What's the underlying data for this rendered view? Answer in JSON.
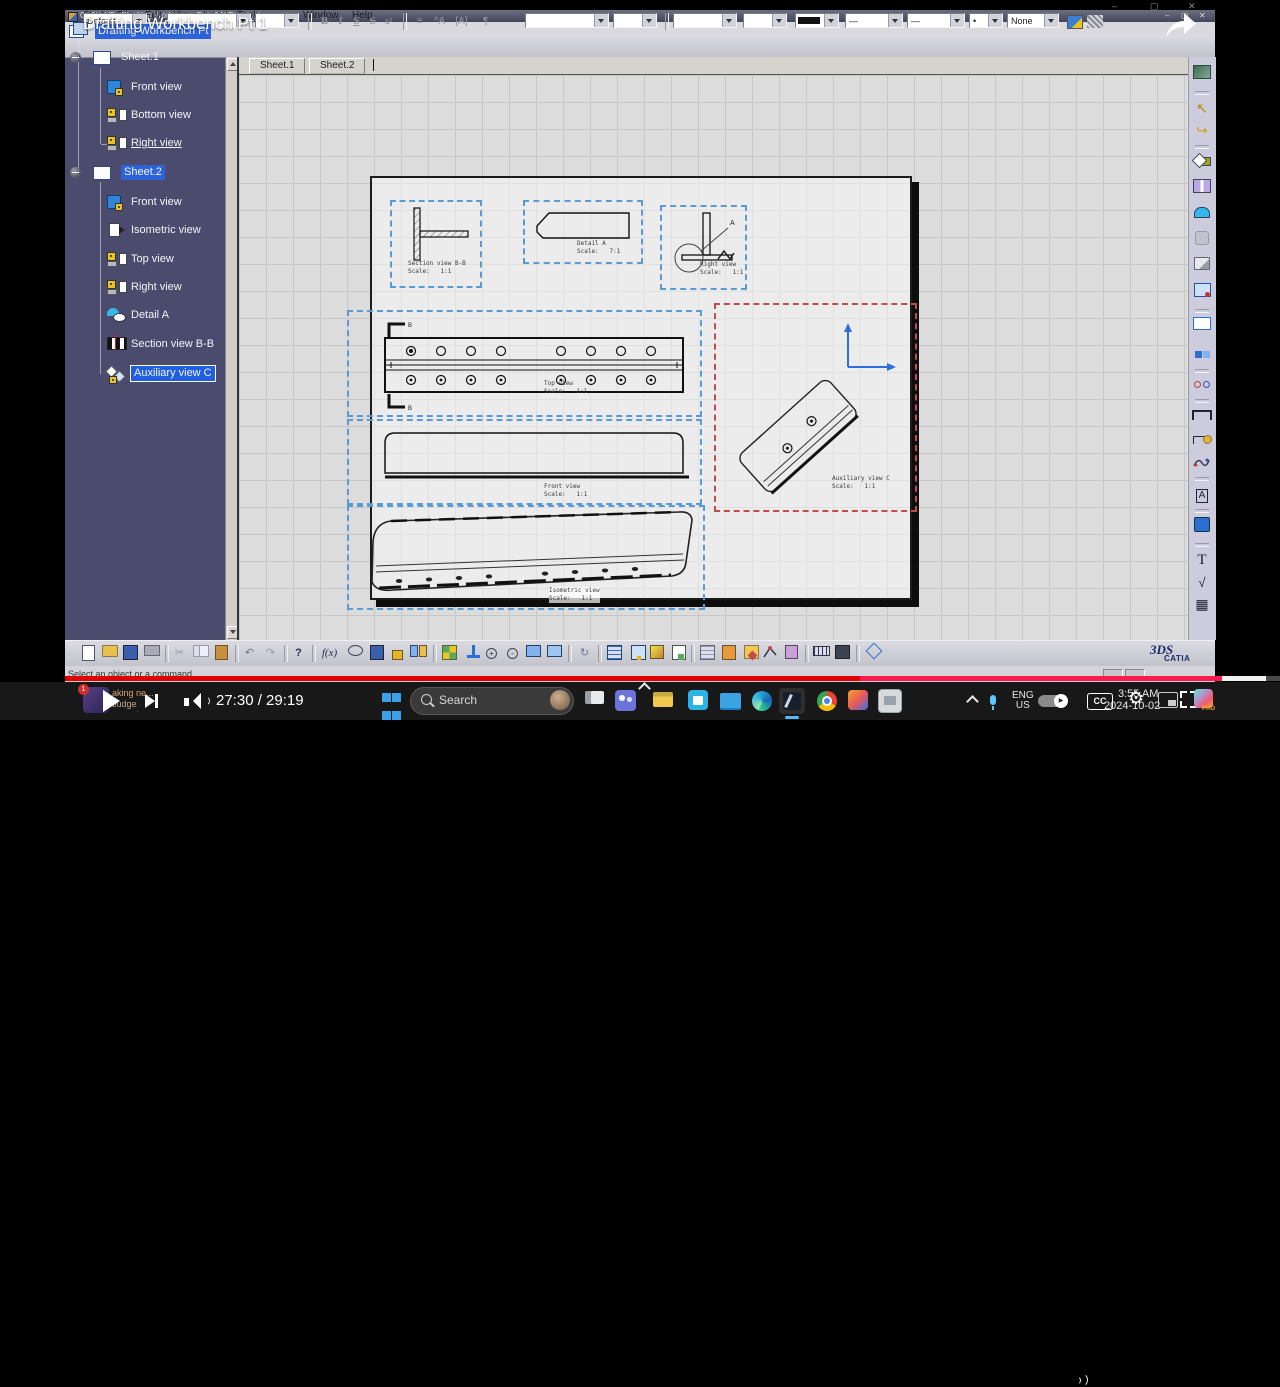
{
  "glyphs": {
    "minus": "–",
    "maximize": "▢",
    "close": "✕",
    "gear": "⚙",
    "bullet": "•",
    "dash": "—",
    "check": "√",
    "table": "▦",
    "cursor": "↖",
    "sweep": "↪",
    "text_tool": "T",
    "boxed_a": "A",
    "fx": "f(x)",
    "help": "?",
    "undo": "↶",
    "redo": "↷",
    "refresh": "↻",
    "zoom_plus": "+",
    "zoom_minus": "-",
    "play_small": "▶"
  },
  "window": {
    "title": "CATIA V5 - [Drafting Workbench Pt 1.CATDrawing]"
  },
  "overlay": {
    "video_title": "Drafting Workbench Pt 1"
  },
  "menubar": {
    "items": [
      "Start",
      "File",
      "Edit",
      "View",
      "Insert",
      "Tools",
      "Window",
      "Help"
    ]
  },
  "toolbar": {
    "style": "Default",
    "bold": "B",
    "italic": "I",
    "underline": "S",
    "strike": "S",
    "sup": "x²",
    "none": "None"
  },
  "tree": {
    "root": "Drafting Workbench Pt",
    "sheet1": "Sheet.1",
    "s1_front": "Front view",
    "s1_bottom": "Bottom view",
    "s1_right": "Right view",
    "sheet2": "Sheet.2",
    "s2_front": "Front view",
    "s2_iso": "Isometric view",
    "s2_top": "Top view",
    "s2_right": "Right view",
    "s2_detail": "Detail A",
    "s2_section": "Section view B-B",
    "s2_aux": "Auxiliary view C"
  },
  "tabs": {
    "sheet1": "Sheet.1",
    "sheet2": "Sheet.2"
  },
  "views": {
    "section_name": "Section view B-B",
    "section_scale": "Scale:   1:1",
    "detail_name": "Detail A",
    "detail_scale": "Scale:   7:1",
    "right_name": "Right view",
    "right_scale": "Scale:   1:1",
    "top_name": "Top view",
    "top_scale": "Scale:   1:1",
    "front_name": "Front view",
    "front_scale": "Scale:   1:1",
    "iso_name": "Isometric view",
    "iso_scale": "Scale:   1:1",
    "aux_name": "Auxiliary view C",
    "aux_scale": "Scale:   1:1",
    "mark_a": "A",
    "mark_b": "B"
  },
  "statusbar": {
    "message": "Select an object or a command"
  },
  "logo": {
    "mark": "3DS",
    "name": "CATIA"
  },
  "player": {
    "time_display": "27:30 / 29:19",
    "cc": "CC",
    "news_badge": "1",
    "news_line1": "aking ne...",
    "news_line2": "Judge unseals cr..."
  },
  "taskbar": {
    "search": "Search",
    "lang_top": "ENG",
    "lang_bottom": "US",
    "time": "3:55 AM",
    "date": "2024-10-02",
    "pro": "PRO"
  },
  "colors": {
    "selection_blue": "#2c63d8",
    "view_frame_blue": "#5b9bd5",
    "active_frame_red": "#c24b4b",
    "progress_red": "#e00000",
    "progress_pink": "#ff1a4d"
  }
}
